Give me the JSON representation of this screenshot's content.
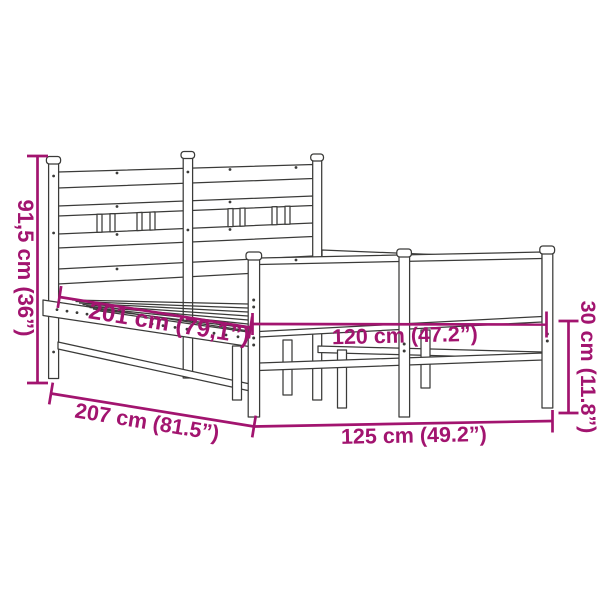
{
  "page": {
    "background_color": "#ffffff"
  },
  "diagram": {
    "kind": "product-dimension-drawing",
    "subject": "metal bed frame with headboard and footboard",
    "ink_color": "#3b3b39",
    "dimension_color": "#a2146f",
    "dimensions": {
      "headboard_height": "91,5 cm (36”)",
      "slat_length": "201 cm (79,1”)",
      "total_length": "207 cm (81.5”)",
      "total_width": "125 cm (49.2”)",
      "slat_width": "120 cm (47.2”)",
      "footboard_height": "30 cm (11.8”)"
    }
  }
}
